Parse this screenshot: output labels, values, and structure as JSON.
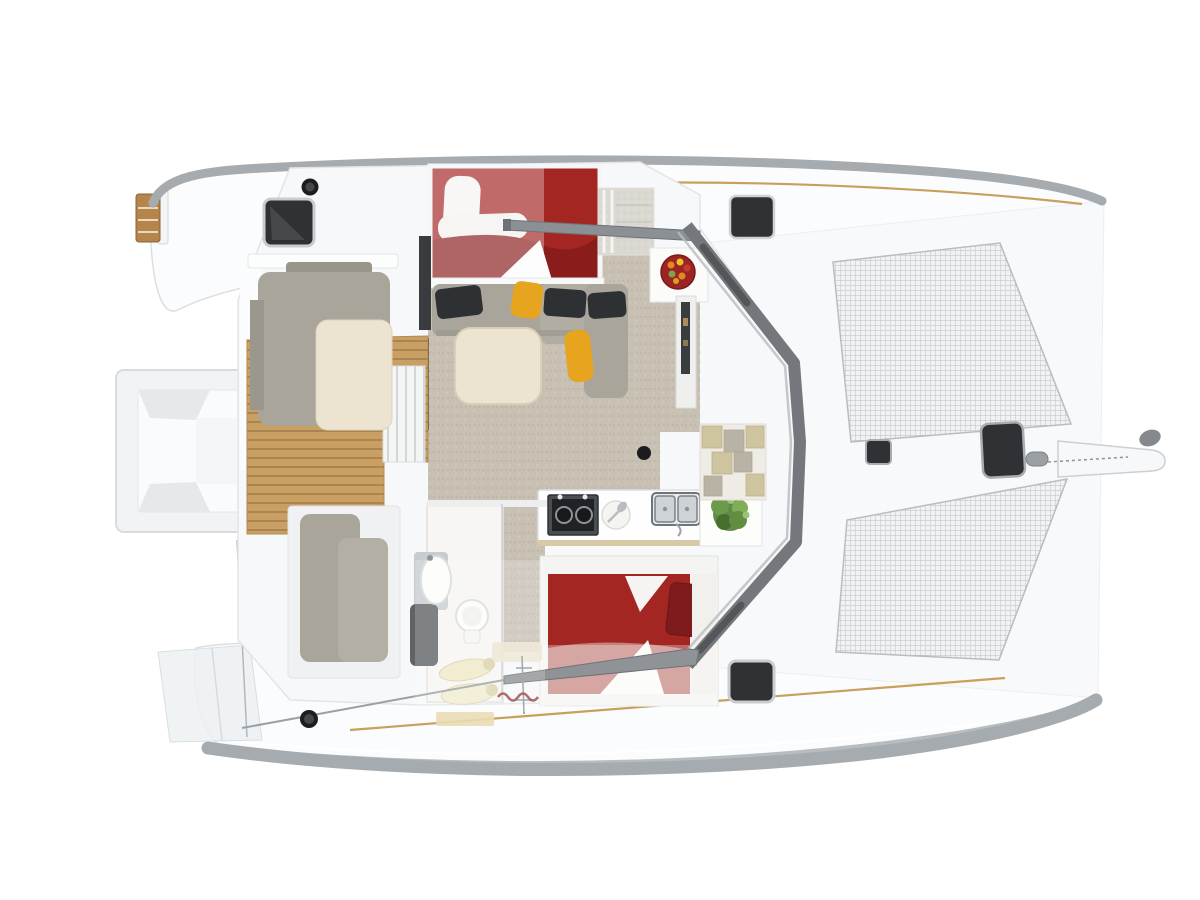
{
  "regions": {
    "vessel": "catamaran-top-view-floorplan",
    "hulls": [
      "top-hull",
      "bottom-hull"
    ],
    "bow": [
      "trampoline-top",
      "trampoline-bottom",
      "bowsprit",
      "anchor-roller",
      "bow-hatch-large",
      "bow-hatch-small",
      "windlass"
    ],
    "stern": [
      "stern-platform",
      "swim-ladder",
      "transom-steps"
    ],
    "cockpit": [
      "wood-deck",
      "lounge-sofa",
      "lounge-cushion",
      "helm-seats",
      "winch-top",
      "winch-bottom"
    ],
    "saloon": [
      "carpet-floor",
      "l-sofa",
      "black-pillows",
      "yellow-pillows",
      "dinette-table",
      "compression-post"
    ],
    "galley": [
      "counter",
      "two-burner-stove",
      "plate-with-spoon",
      "double-sink",
      "plant",
      "fruit-bowl",
      "tall-locker"
    ],
    "cabins": [
      "forward-double-bed",
      "aft-double-bed"
    ],
    "bathroom": [
      "vanity-sink",
      "toilet",
      "shower-wands",
      "bath-mat"
    ],
    "structure": [
      "coachroof-windshield",
      "boom",
      "mainsheet",
      "entry-steps",
      "hull-steps",
      "deck-hatches",
      "brand-logo-squiggle"
    ]
  },
  "colors": {
    "background": "#ffffff",
    "hull_white": "#fbfcfd",
    "hull_edge_gray": "#a6abaf",
    "toe_rail_wood": "#c8a05c",
    "trampoline_base": "#f1f2f3",
    "trampoline_grid": "#a7abae",
    "carpet": "#c7c0b3",
    "wood_floor": "#c99f63",
    "wood_floor_stripe": "#a9854f",
    "bed_red": "#a32622",
    "bed_red_dark": "#8a1d1b",
    "bed_red_light": "#c5807b",
    "pillow_black": "#2d3134",
    "pillow_yellow": "#e6a41f",
    "sofa_gray": "#a9a59b",
    "seat_cream": "#ece3d0",
    "counter_white": "#fefefe",
    "stove_black": "#202325",
    "sink_steel": "#ced3d8",
    "plant_green": "#55803c",
    "fruit_bowl_red": "#9c2424",
    "hatch_dark": "#2f3235",
    "windshield_gray": "#74787c",
    "boom_gray": "#8f9397",
    "step_tile_tan": "#cec49f",
    "step_tile_gray": "#b9b3a6",
    "ladder_wood": "#b5854a",
    "logo_red": "#8e2a28"
  }
}
